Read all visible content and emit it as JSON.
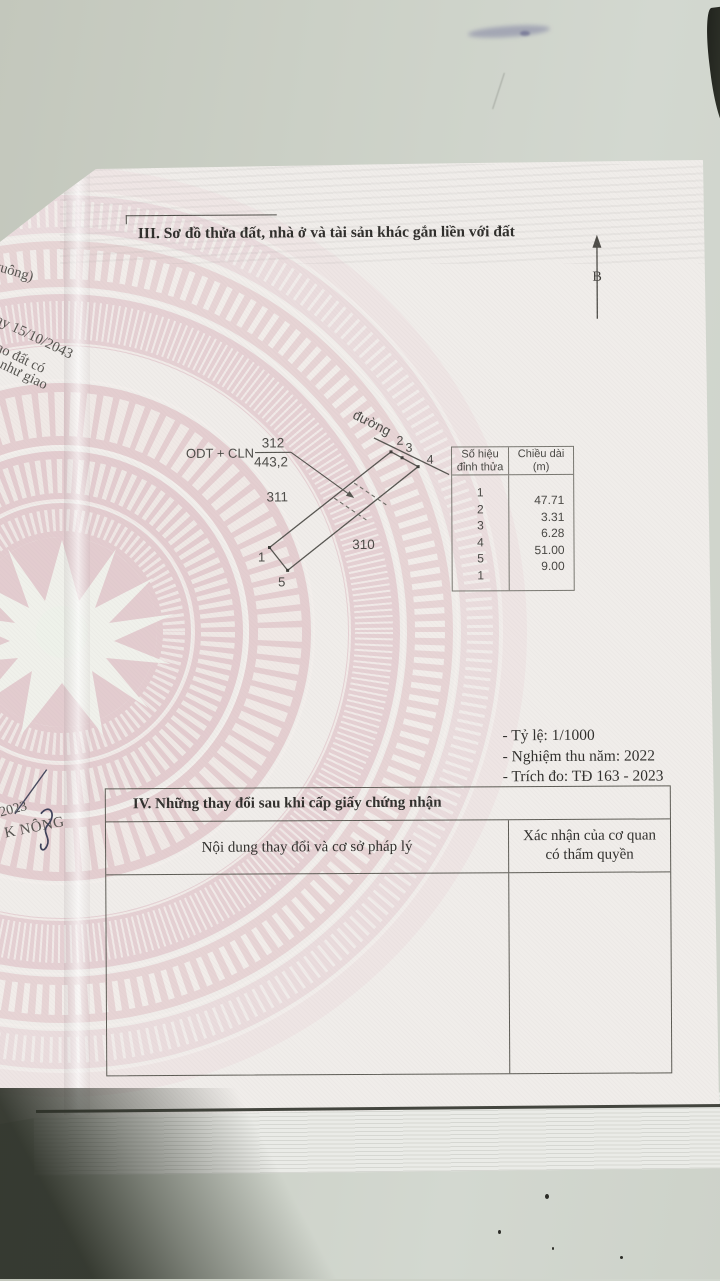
{
  "document": {
    "section_iii": {
      "title": "III. Sơ đồ thửa đất, nhà ở và tài sản khác gắn liền với đất"
    },
    "north_arrow_label": "B",
    "diagram": {
      "road_label": "đường",
      "land_use_code": "ODT + CLN",
      "plot_number": "312",
      "plot_area": "443,2",
      "neighbor_plot_left": "311",
      "neighbor_plot_right": "310",
      "vertex_1": "1",
      "vertex_2": "2",
      "vertex_3": "3",
      "vertex_4": "4",
      "vertex_5": "5"
    },
    "vertex_table": {
      "col1_line1": "Số hiệu",
      "col1_line2": "đỉnh thửa",
      "col2_line1": "Chiều dài",
      "col2_line2": "(m)",
      "vertices": [
        "1",
        "2",
        "3",
        "4",
        "5",
        "1"
      ],
      "lengths": [
        "47.71",
        "3.31",
        "6.28",
        "51.00",
        "9.00"
      ]
    },
    "notes": {
      "scale": "- Tỷ lệ: 1/1000",
      "acceptance": "- Nghiệm thu năm: 2022",
      "survey": "- Trích đo: TĐ 163 - 2023"
    },
    "section_iv": {
      "title": "IV. Những thay đổi sau khi cấp giấy chứng nhận",
      "col1_header": "Nội dung thay đổi và cơ sở pháp lý",
      "col2_header": "Xác nhận của cơ quan có thẩm quyền"
    },
    "margin_fragments": {
      "f1": "vuông)",
      "f2": "ay 15/10/2043",
      "f3": "giao đất có",
      "f4": ") như giao",
      "f5": "2023",
      "f6": "K NÔNG"
    }
  }
}
